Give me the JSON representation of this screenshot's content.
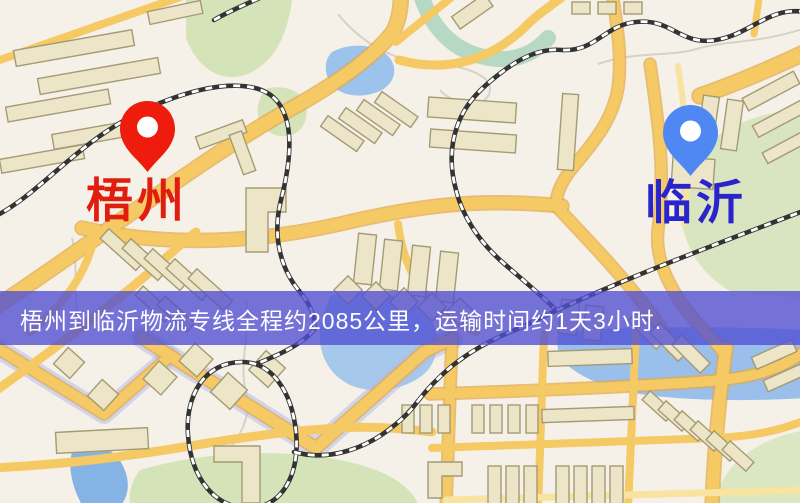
{
  "map": {
    "origin_marker": {
      "label": "梧州",
      "label_color": "#e11e0e",
      "pin_color": "#ee1c0d"
    },
    "destination_marker": {
      "label": "临沂",
      "label_color": "#2a24cb",
      "pin_color": "#4f88f2"
    },
    "banner": {
      "text": "梧州到临沂物流专线全程约2085公里，运输时间约1天3小时.",
      "background_color": "#504ed2",
      "text_color": "#ffffff"
    },
    "legend_colors": {
      "road": "#f5c963",
      "road_casing": "#e2a94c",
      "railway": "#333333",
      "water": "#9cc3eb",
      "park": "#d4e3b8",
      "building": "#ede5c8"
    }
  }
}
